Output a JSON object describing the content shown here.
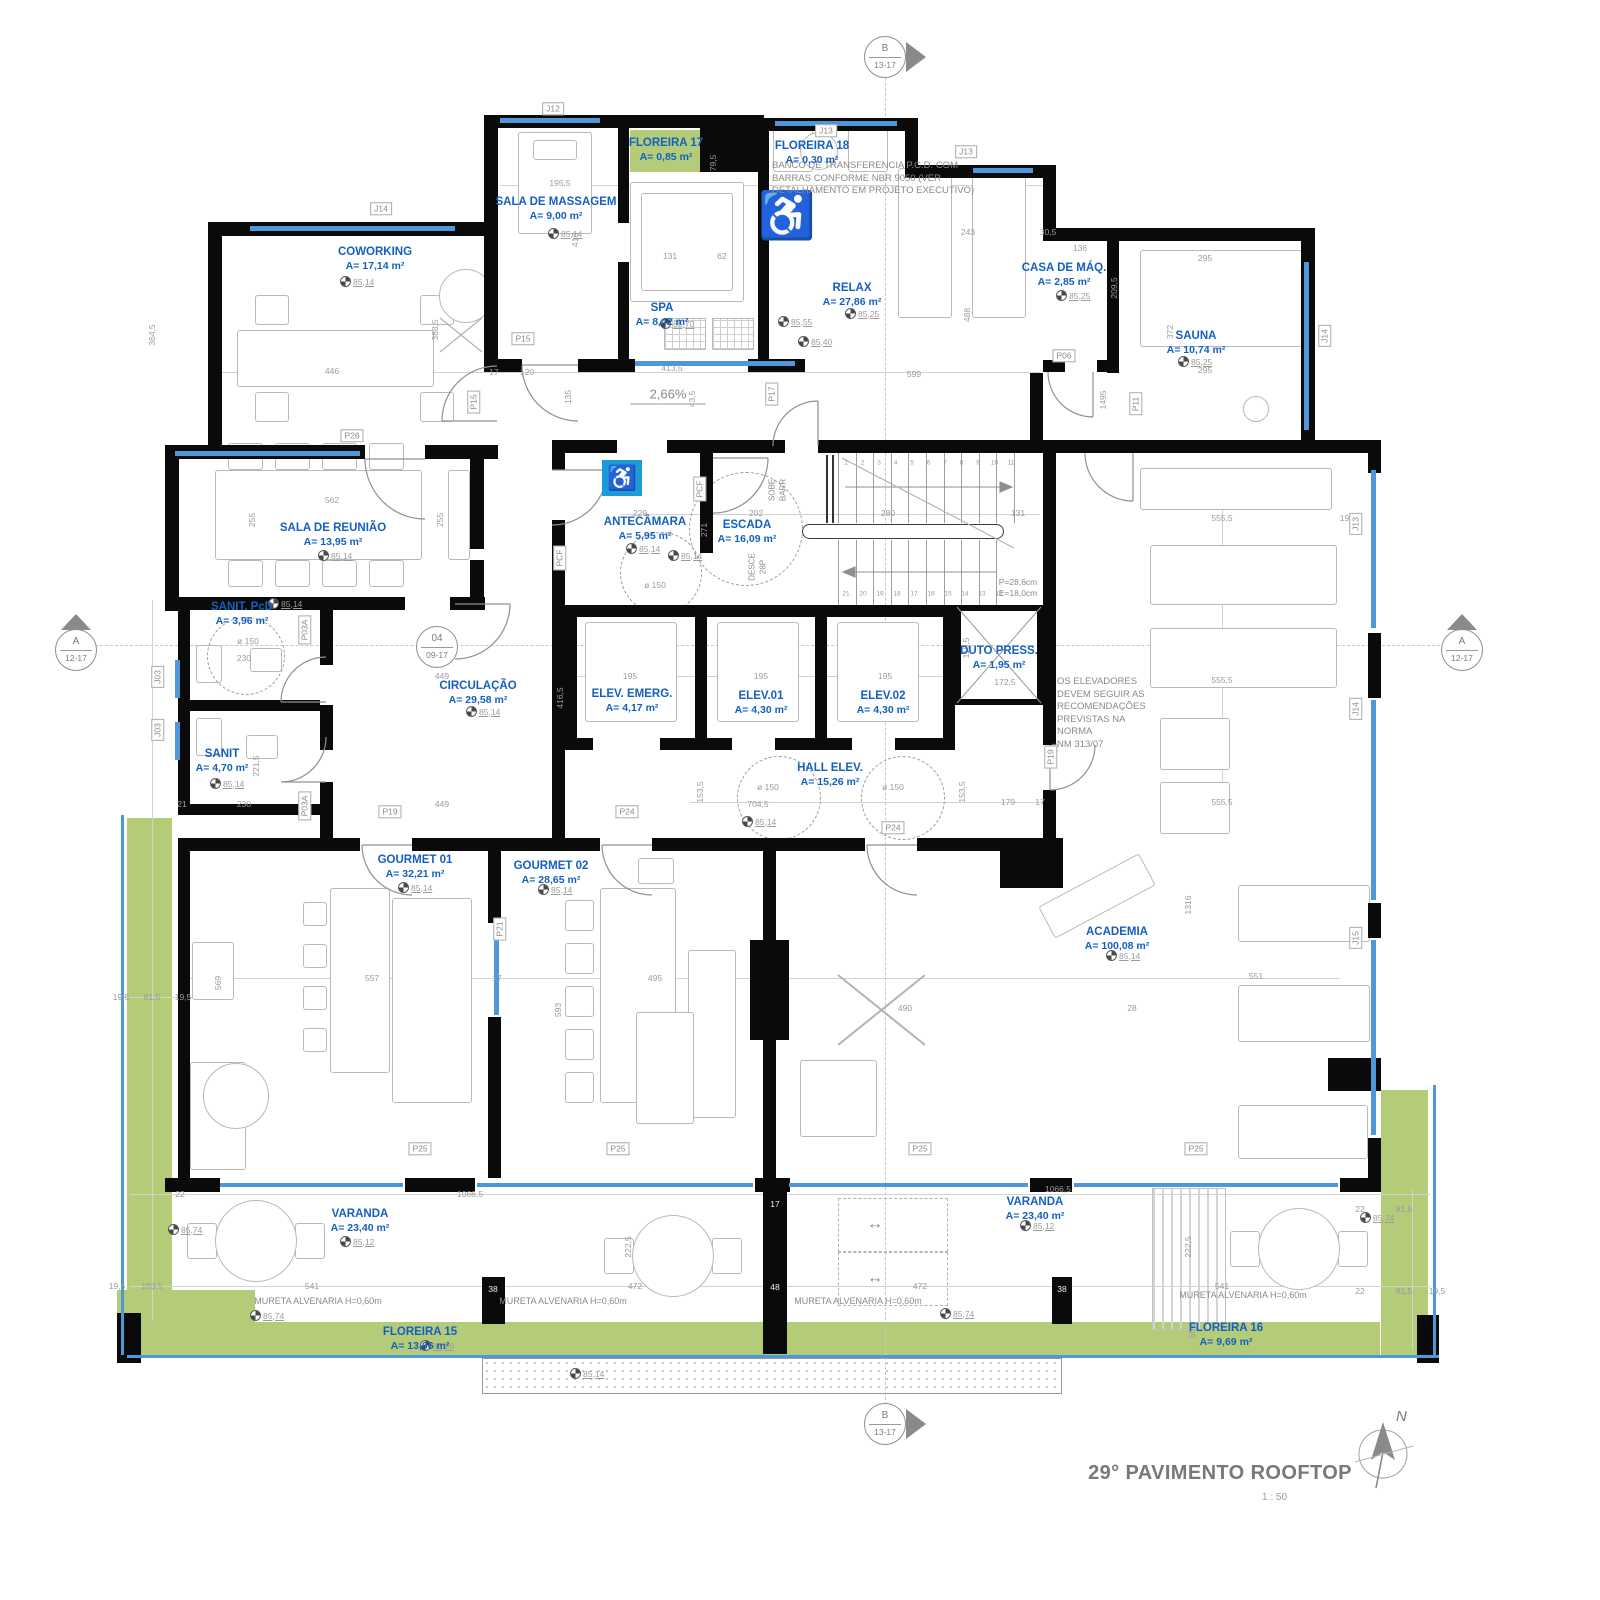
{
  "title": {
    "text": "29° PAVIMENTO ROOFTOP",
    "scale": "1 : 50",
    "north": "N"
  },
  "markers": {
    "top": {
      "letter": "B",
      "range": "13-17"
    },
    "bottom": {
      "letter": "B",
      "range": "13-17"
    },
    "left": {
      "letter": "A",
      "range": "12-17"
    },
    "right": {
      "letter": "A",
      "range": "12-17"
    },
    "detail": {
      "letter": "04",
      "range": "09-17"
    }
  },
  "colors": {
    "wall": "#0a0a0a",
    "window": "#4f97d9",
    "green": "#b4cb78",
    "room_label": "#1460c0",
    "dim": "#9b9b9b",
    "accessible_blue": "#1d9bd8"
  },
  "icons": {
    "accessible": "♿",
    "wheelchair_gray": "♿",
    "double_arrow": "↔"
  },
  "rooms": [
    {
      "name": "COWORKING",
      "area": "A= 17,14 m²",
      "x": 375,
      "y": 246
    },
    {
      "name": "SALA DE MASSAGEM",
      "area": "A= 9,00 m²",
      "x": 556,
      "y": 196
    },
    {
      "name": "FLOREIRA 17",
      "area": "A= 0,85 m²",
      "x": 666,
      "y": 137
    },
    {
      "name": "FLOREIRA 18",
      "area": "A= 0,30 m²",
      "x": 812,
      "y": 140
    },
    {
      "name": "SPA",
      "area": "A= 8,42 m²",
      "x": 662,
      "y": 302
    },
    {
      "name": "RELAX",
      "area": "A= 27,86 m²",
      "x": 852,
      "y": 282
    },
    {
      "name": "CASA DE MÁQ.",
      "area": "A= 2,85 m²",
      "x": 1064,
      "y": 262
    },
    {
      "name": "SAUNA",
      "area": "A= 10,74 m²",
      "x": 1196,
      "y": 330
    },
    {
      "name": "SALA DE REUNIÃO",
      "area": "A= 13,95 m²",
      "x": 333,
      "y": 522
    },
    {
      "name": "ANTECÂMARA",
      "area": "A= 5,95 m²",
      "x": 645,
      "y": 516
    },
    {
      "name": "ESCADA",
      "area": "A= 16,09 m²",
      "x": 747,
      "y": 519
    },
    {
      "name": "SANIT. PcD",
      "area": "A= 3,96 m²",
      "x": 242,
      "y": 601
    },
    {
      "name": "SANIT",
      "area": "A= 4,70 m²",
      "x": 222,
      "y": 748
    },
    {
      "name": "CIRCULAÇÃO",
      "area": "A= 29,58 m²",
      "x": 478,
      "y": 680
    },
    {
      "name": "ELEV. EMERG.",
      "area": "A= 4,17 m²",
      "x": 632,
      "y": 688
    },
    {
      "name": "ELEV.01",
      "area": "A= 4,30 m²",
      "x": 761,
      "y": 690
    },
    {
      "name": "ELEV.02",
      "area": "A= 4,30 m²",
      "x": 883,
      "y": 690
    },
    {
      "name": "DUTO PRESS.",
      "area": "A= 1,95 m²",
      "x": 999,
      "y": 645
    },
    {
      "name": "HALL ELEV.",
      "area": "A= 15,26 m²",
      "x": 830,
      "y": 762
    },
    {
      "name": "GOURMET 01",
      "area": "A= 32,21 m²",
      "x": 415,
      "y": 854
    },
    {
      "name": "GOURMET 02",
      "area": "A= 28,65 m²",
      "x": 551,
      "y": 860
    },
    {
      "name": "ACADEMIA",
      "area": "A= 100,08 m²",
      "x": 1117,
      "y": 926
    },
    {
      "name": "VARANDA",
      "area": "A= 23,40 m²",
      "x": 360,
      "y": 1208
    },
    {
      "name": "VARANDA",
      "area": "A= 23,40 m²",
      "x": 1035,
      "y": 1196
    },
    {
      "name": "FLOREIRA 15",
      "area": "A= 13,66 m²",
      "x": 420,
      "y": 1326
    },
    {
      "name": "FLOREIRA 16",
      "area": "A= 9,69 m²",
      "x": 1226,
      "y": 1322
    }
  ],
  "annotations": [
    {
      "t": "BANCO DE TRANSFERENCIA P.C.D. COM\nBARRAS CONFORME NBR 9050 (VER\nDETALHAMENTO EM PROJETO EXECUTIVO)",
      "x": 772,
      "y": 160
    },
    {
      "t": "OS ELEVADORES\nDEVEM SEGUIR AS\nRECOMENDAÇÕES\nPREVISTAS NA\nNORMA\nNM 313/07",
      "x": 1057,
      "y": 676
    },
    {
      "t": "2,66%",
      "x": 668,
      "y": 394,
      "c": 1,
      "size": 13
    },
    {
      "t": "P=28,6cm\nE=18,0cm",
      "x": 1018,
      "y": 588,
      "c": 1,
      "size": 8.5
    },
    {
      "t": "MURETA ALVENARIA H=0,60m",
      "x": 318,
      "y": 1302,
      "c": 1,
      "size": 9
    },
    {
      "t": "MURETA ALVENARIA H=0,60m",
      "x": 563,
      "y": 1302,
      "c": 1,
      "size": 9
    },
    {
      "t": "MURETA ALVENARIA H=0,60m",
      "x": 858,
      "y": 1302,
      "c": 1,
      "size": 9
    },
    {
      "t": "MURETA ALVENARIA H=0,60m",
      "x": 1243,
      "y": 1296,
      "c": 1,
      "size": 9
    },
    {
      "t": "SOBE\nBARR",
      "x": 778,
      "y": 490,
      "r": 1,
      "size": 8
    },
    {
      "t": "DESCE\n28P",
      "x": 758,
      "y": 567,
      "r": 1,
      "size": 8
    },
    {
      "t": "↔",
      "x": 875,
      "y": 1224,
      "c": 1,
      "size": 16
    },
    {
      "t": "↔",
      "x": 875,
      "y": 1278,
      "c": 1,
      "size": 16
    }
  ],
  "benchmarks": [
    {
      "v": "85,14",
      "x": 340,
      "y": 276
    },
    {
      "v": "85,14",
      "x": 548,
      "y": 228
    },
    {
      "v": "85,70",
      "x": 660,
      "y": 318
    },
    {
      "v": "85,55",
      "x": 778,
      "y": 316
    },
    {
      "v": "85,40",
      "x": 798,
      "y": 336
    },
    {
      "v": "85,25",
      "x": 845,
      "y": 308
    },
    {
      "v": "85,25",
      "x": 1056,
      "y": 290
    },
    {
      "v": "85,25",
      "x": 1178,
      "y": 356
    },
    {
      "v": "85,14",
      "x": 318,
      "y": 550
    },
    {
      "v": "85,14",
      "x": 268,
      "y": 598
    },
    {
      "v": "85,14",
      "x": 210,
      "y": 778
    },
    {
      "v": "85,14",
      "x": 466,
      "y": 706
    },
    {
      "v": "85,14",
      "x": 626,
      "y": 543
    },
    {
      "v": "85,14",
      "x": 668,
      "y": 550
    },
    {
      "v": "85,14",
      "x": 742,
      "y": 816
    },
    {
      "v": "85,14",
      "x": 398,
      "y": 882
    },
    {
      "v": "85,14",
      "x": 538,
      "y": 884
    },
    {
      "v": "85,14",
      "x": 1106,
      "y": 950
    },
    {
      "v": "85,12",
      "x": 340,
      "y": 1236
    },
    {
      "v": "85,12",
      "x": 1020,
      "y": 1220
    },
    {
      "v": "85,74",
      "x": 168,
      "y": 1224
    },
    {
      "v": "85,74",
      "x": 250,
      "y": 1310
    },
    {
      "v": "85,74",
      "x": 940,
      "y": 1308
    },
    {
      "v": "85,74",
      "x": 1360,
      "y": 1212
    },
    {
      "v": "85,29",
      "x": 420,
      "y": 1340
    },
    {
      "v": "85,14",
      "x": 570,
      "y": 1368
    }
  ],
  "dims": [
    {
      "t": "195,5",
      "x": 560,
      "y": 183
    },
    {
      "t": "413",
      "x": 575,
      "y": 240,
      "r": 1
    },
    {
      "t": "131",
      "x": 670,
      "y": 256
    },
    {
      "t": "62",
      "x": 722,
      "y": 256
    },
    {
      "t": "79,5",
      "x": 713,
      "y": 163,
      "r": 1
    },
    {
      "t": "243",
      "x": 968,
      "y": 232
    },
    {
      "t": "30,5",
      "x": 1048,
      "y": 232
    },
    {
      "t": "136",
      "x": 1080,
      "y": 248
    },
    {
      "t": "209,5",
      "x": 1114,
      "y": 288,
      "r": 1
    },
    {
      "t": "295",
      "x": 1205,
      "y": 258
    },
    {
      "t": "372",
      "x": 1170,
      "y": 332,
      "r": 1
    },
    {
      "t": "295",
      "x": 1205,
      "y": 370
    },
    {
      "t": "388,5",
      "x": 435,
      "y": 330,
      "r": 1
    },
    {
      "t": "446",
      "x": 332,
      "y": 371
    },
    {
      "t": "364,5",
      "x": 152,
      "y": 335,
      "r": 1
    },
    {
      "t": "17",
      "x": 494,
      "y": 372
    },
    {
      "t": "120",
      "x": 527,
      "y": 372
    },
    {
      "t": "413,5",
      "x": 672,
      "y": 368
    },
    {
      "t": "43,5",
      "x": 692,
      "y": 399,
      "r": 1
    },
    {
      "t": "135",
      "x": 568,
      "y": 397,
      "r": 1
    },
    {
      "t": "599",
      "x": 914,
      "y": 374
    },
    {
      "t": "1495",
      "x": 1103,
      "y": 400,
      "r": 1
    },
    {
      "t": "488",
      "x": 967,
      "y": 315,
      "r": 1
    },
    {
      "t": "562",
      "x": 332,
      "y": 500
    },
    {
      "t": "255",
      "x": 252,
      "y": 520,
      "r": 1
    },
    {
      "t": "255",
      "x": 440,
      "y": 520,
      "r": 1
    },
    {
      "t": "229",
      "x": 640,
      "y": 513
    },
    {
      "t": "202",
      "x": 756,
      "y": 513
    },
    {
      "t": "280",
      "x": 888,
      "y": 513
    },
    {
      "t": "131",
      "x": 1018,
      "y": 513
    },
    {
      "t": "271",
      "x": 704,
      "y": 530,
      "r": 1
    },
    {
      "t": "ø 150",
      "x": 655,
      "y": 585
    },
    {
      "t": "ø 150",
      "x": 248,
      "y": 641
    },
    {
      "t": "195",
      "x": 630,
      "y": 676
    },
    {
      "t": "195",
      "x": 761,
      "y": 676
    },
    {
      "t": "195",
      "x": 885,
      "y": 676
    },
    {
      "t": "119,5",
      "x": 966,
      "y": 648,
      "r": 1
    },
    {
      "t": "172,5",
      "x": 1005,
      "y": 682
    },
    {
      "t": "230",
      "x": 244,
      "y": 658
    },
    {
      "t": "230",
      "x": 244,
      "y": 804
    },
    {
      "t": "221,5",
      "x": 256,
      "y": 766,
      "r": 1
    },
    {
      "t": "21",
      "x": 182,
      "y": 804
    },
    {
      "t": "416,5",
      "x": 560,
      "y": 698,
      "r": 1
    },
    {
      "t": "449",
      "x": 442,
      "y": 676
    },
    {
      "t": "449",
      "x": 442,
      "y": 804
    },
    {
      "t": "704,5",
      "x": 758,
      "y": 804
    },
    {
      "t": "ø 150",
      "x": 768,
      "y": 787
    },
    {
      "t": "ø 150",
      "x": 893,
      "y": 787
    },
    {
      "t": "153,5",
      "x": 700,
      "y": 792,
      "r": 1
    },
    {
      "t": "153,5",
      "x": 962,
      "y": 792,
      "r": 1
    },
    {
      "t": "179",
      "x": 1008,
      "y": 802
    },
    {
      "t": "17",
      "x": 1040,
      "y": 802
    },
    {
      "t": "78",
      "x": 1055,
      "y": 748,
      "r": 1
    },
    {
      "t": "555,5",
      "x": 1222,
      "y": 518
    },
    {
      "t": "555,5",
      "x": 1222,
      "y": 680
    },
    {
      "t": "555,5",
      "x": 1222,
      "y": 802
    },
    {
      "t": "19,5",
      "x": 1348,
      "y": 518
    },
    {
      "t": "1316",
      "x": 1188,
      "y": 905,
      "r": 1
    },
    {
      "t": "557",
      "x": 372,
      "y": 978
    },
    {
      "t": "569",
      "x": 218,
      "y": 983,
      "r": 1
    },
    {
      "t": "17",
      "x": 497,
      "y": 978
    },
    {
      "t": "495",
      "x": 655,
      "y": 978
    },
    {
      "t": "593",
      "x": 558,
      "y": 1010,
      "r": 1
    },
    {
      "t": "490",
      "x": 905,
      "y": 1008
    },
    {
      "t": "28",
      "x": 1132,
      "y": 1008
    },
    {
      "t": "551",
      "x": 1256,
      "y": 976
    },
    {
      "t": "1066,5",
      "x": 470,
      "y": 1194
    },
    {
      "t": "1066,5",
      "x": 1058,
      "y": 1189
    },
    {
      "t": "22",
      "x": 180,
      "y": 1194
    },
    {
      "t": "222,5",
      "x": 628,
      "y": 1247,
      "r": 1
    },
    {
      "t": "222,5",
      "x": 1188,
      "y": 1247,
      "r": 1
    },
    {
      "t": "103,5",
      "x": 152,
      "y": 1286
    },
    {
      "t": "19,5",
      "x": 117,
      "y": 1286
    },
    {
      "t": "541",
      "x": 312,
      "y": 1286
    },
    {
      "t": "472",
      "x": 635,
      "y": 1286
    },
    {
      "t": "472",
      "x": 920,
      "y": 1286
    },
    {
      "t": "541",
      "x": 1222,
      "y": 1286
    },
    {
      "t": "55,5",
      "x": 1192,
      "y": 1330,
      "r": 1
    },
    {
      "t": "19,5",
      "x": 121,
      "y": 997
    },
    {
      "t": "81,5",
      "x": 152,
      "y": 997
    },
    {
      "t": "19,5",
      "x": 183,
      "y": 997
    },
    {
      "t": "22",
      "x": 1360,
      "y": 1209
    },
    {
      "t": "81,5",
      "x": 1404,
      "y": 1209
    },
    {
      "t": "22",
      "x": 1360,
      "y": 1291
    },
    {
      "t": "81,5",
      "x": 1404,
      "y": 1291
    },
    {
      "t": "19,5",
      "x": 1437,
      "y": 1291
    },
    {
      "t": "48",
      "x": 775,
      "y": 1287,
      "w": 1
    },
    {
      "t": "38",
      "x": 493,
      "y": 1289,
      "w": 1
    },
    {
      "t": "38",
      "x": 1062,
      "y": 1289,
      "w": 1
    },
    {
      "t": "17",
      "x": 775,
      "y": 1204,
      "w": 1
    }
  ],
  "tags": [
    {
      "t": "J12",
      "x": 553,
      "y": 109
    },
    {
      "t": "J14",
      "x": 381,
      "y": 209
    },
    {
      "t": "J13",
      "x": 826,
      "y": 131
    },
    {
      "t": "J13",
      "x": 966,
      "y": 152
    },
    {
      "t": "J14",
      "x": 1325,
      "y": 336,
      "r": 1
    },
    {
      "t": "P15",
      "x": 523,
      "y": 339
    },
    {
      "t": "P15",
      "x": 474,
      "y": 402,
      "r": 1
    },
    {
      "t": "P26",
      "x": 352,
      "y": 436
    },
    {
      "t": "P17",
      "x": 772,
      "y": 394,
      "r": 1
    },
    {
      "t": "P06",
      "x": 1064,
      "y": 356
    },
    {
      "t": "P11",
      "x": 1136,
      "y": 404,
      "r": 1
    },
    {
      "t": "PCF",
      "x": 700,
      "y": 489,
      "r": 1
    },
    {
      "t": "PCF",
      "x": 560,
      "y": 558,
      "r": 1
    },
    {
      "t": "P03A",
      "x": 305,
      "y": 630,
      "r": 1
    },
    {
      "t": "P03A",
      "x": 305,
      "y": 806,
      "r": 1
    },
    {
      "t": "P19",
      "x": 390,
      "y": 812
    },
    {
      "t": "P24",
      "x": 627,
      "y": 812
    },
    {
      "t": "P24",
      "x": 893,
      "y": 828
    },
    {
      "t": "P19",
      "x": 1051,
      "y": 757,
      "r": 1
    },
    {
      "t": "P21",
      "x": 500,
      "y": 929,
      "r": 1
    },
    {
      "t": "P25",
      "x": 420,
      "y": 1149
    },
    {
      "t": "P25",
      "x": 618,
      "y": 1149
    },
    {
      "t": "P25",
      "x": 920,
      "y": 1149
    },
    {
      "t": "P25",
      "x": 1196,
      "y": 1149
    },
    {
      "t": "J03",
      "x": 158,
      "y": 677,
      "r": 1
    },
    {
      "t": "J03",
      "x": 158,
      "y": 730,
      "r": 1
    },
    {
      "t": "J13",
      "x": 1356,
      "y": 524,
      "r": 1
    },
    {
      "t": "J14",
      "x": 1356,
      "y": 709,
      "r": 1
    },
    {
      "t": "J15",
      "x": 1356,
      "y": 938,
      "r": 1
    }
  ],
  "stairs": {
    "top_numbers": [
      "1",
      "2",
      "3",
      "4",
      "5",
      "6",
      "7",
      "8",
      "9",
      "10",
      "11"
    ],
    "bottom_numbers": [
      "21",
      "20",
      "19",
      "18",
      "17",
      "16",
      "15",
      "14",
      "13",
      "12"
    ]
  }
}
